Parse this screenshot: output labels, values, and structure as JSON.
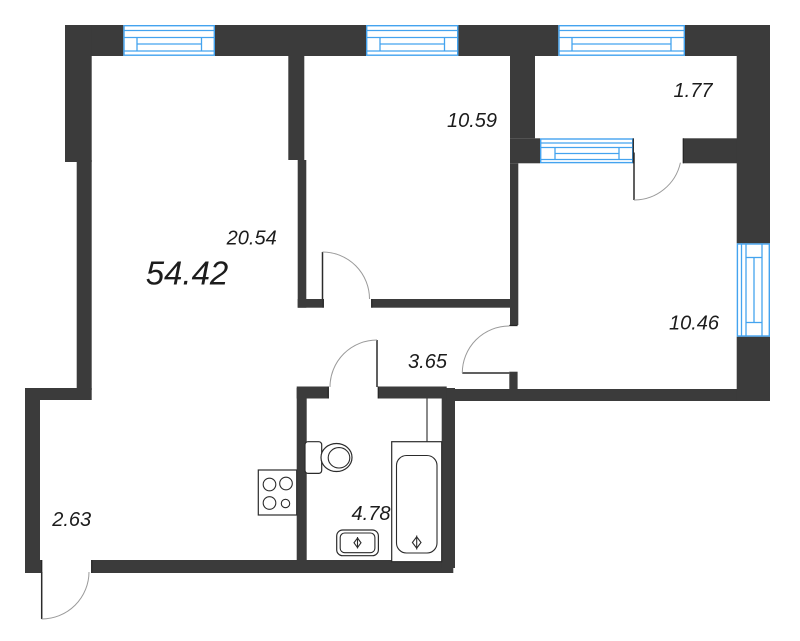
{
  "floor_plan": {
    "type": "apartment-floor-plan",
    "total_area": "54.42",
    "rooms": [
      {
        "key": "living-kitchen",
        "area": "20.54"
      },
      {
        "key": "bedroom-top",
        "area": "10.59"
      },
      {
        "key": "balcony-top",
        "area": "1.77"
      },
      {
        "key": "bedroom-right",
        "area": "10.46"
      },
      {
        "key": "hallway",
        "area": "3.65"
      },
      {
        "key": "bathroom",
        "area": "4.78"
      },
      {
        "key": "balcony-left",
        "area": "2.63"
      }
    ],
    "fixtures": [
      "stove-icon",
      "toilet-icon",
      "bathtub-icon",
      "sink-icon"
    ],
    "windows_count": 5,
    "doors_count": 5,
    "colors": {
      "wall": "#3b3b3b",
      "window": "#44a3ef",
      "text": "#1c1c1c",
      "arc": "#9a9a9a",
      "bg": "#ffffff"
    }
  }
}
